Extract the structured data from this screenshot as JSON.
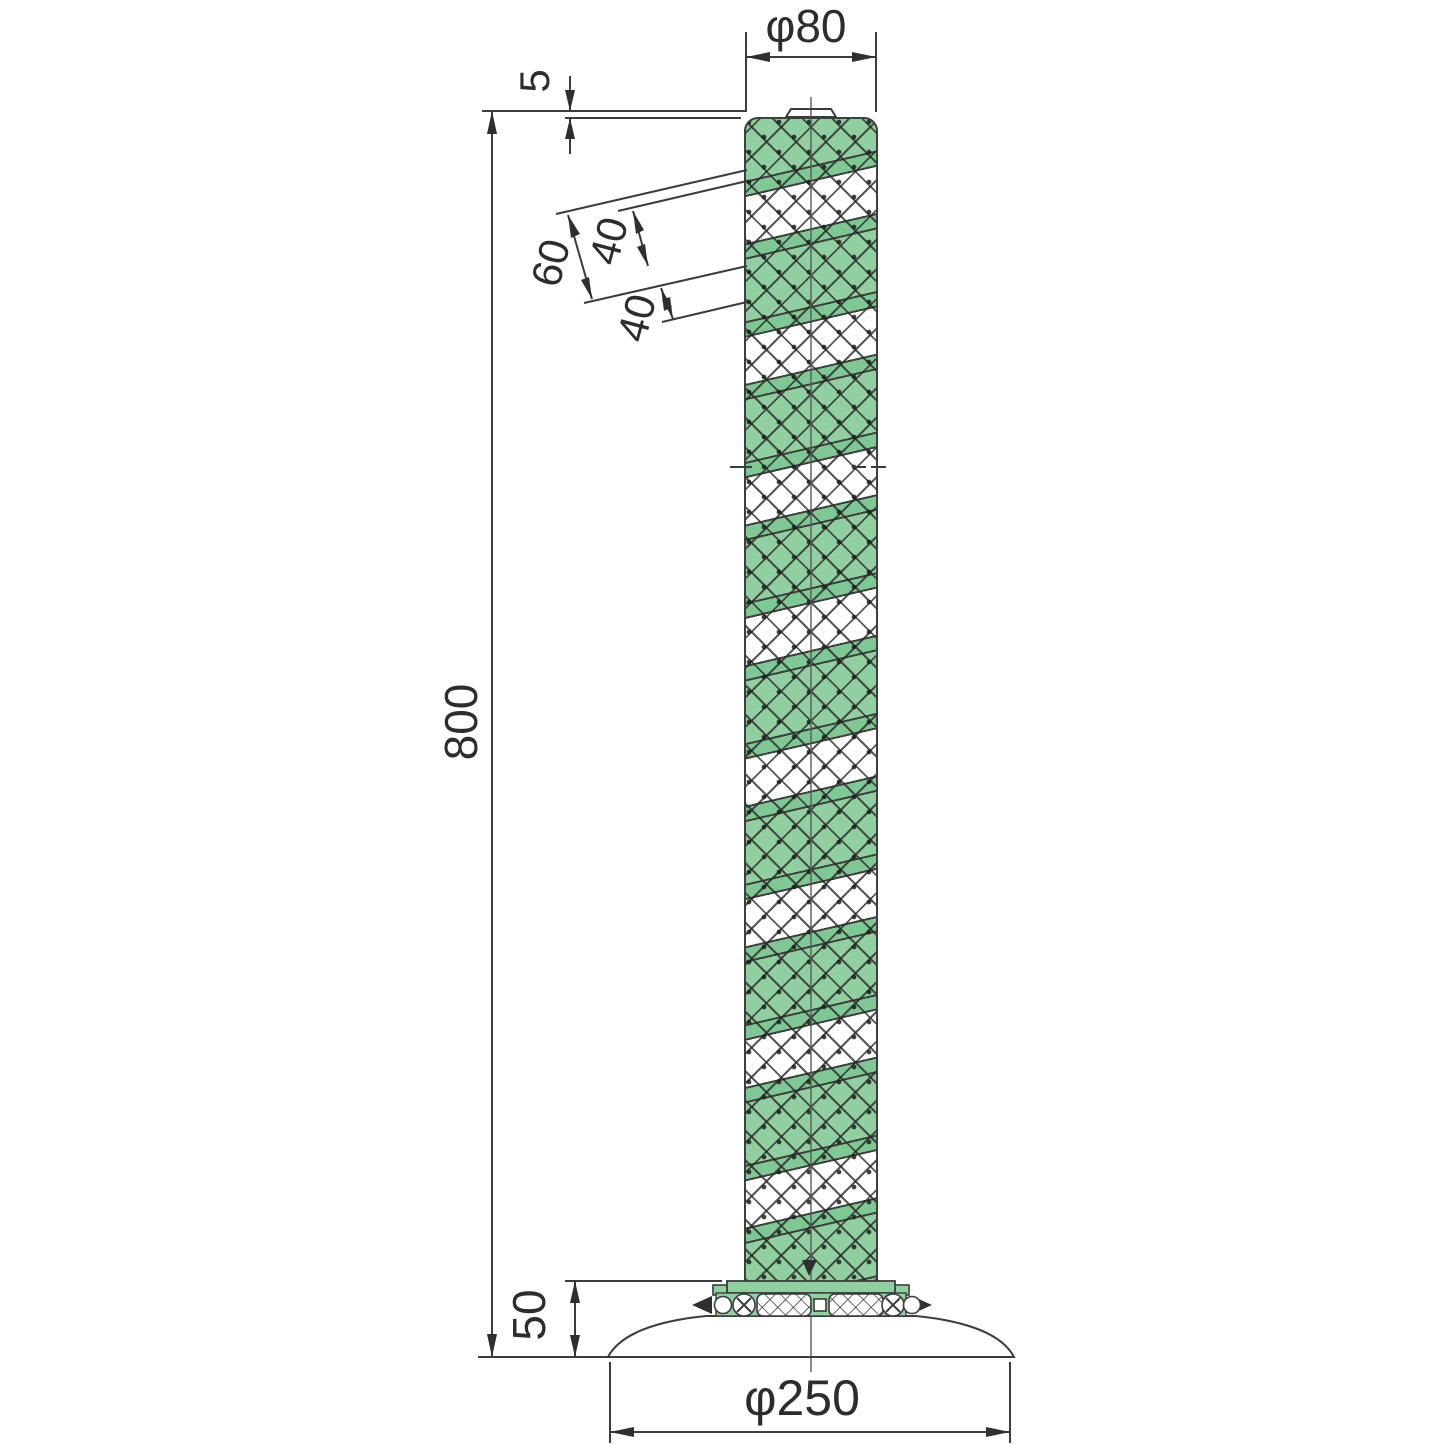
{
  "drawing": {
    "type": "technical-dimension-diagram",
    "subject": "green/white spiral reflective guide post (delineator) with round base, side elevation",
    "dims": {
      "top_diameter": "φ80",
      "cap_height": "5",
      "stripe_band_60": "60",
      "stripe_band_40_upper": "40",
      "stripe_band_40_lower": "40",
      "overall_height": "800",
      "base_height": "50",
      "base_diameter": "φ250"
    },
    "colors": {
      "band_green": "#90cf9f",
      "stripe_green": "#7ec893",
      "line_color": "#3c3c3c"
    }
  }
}
